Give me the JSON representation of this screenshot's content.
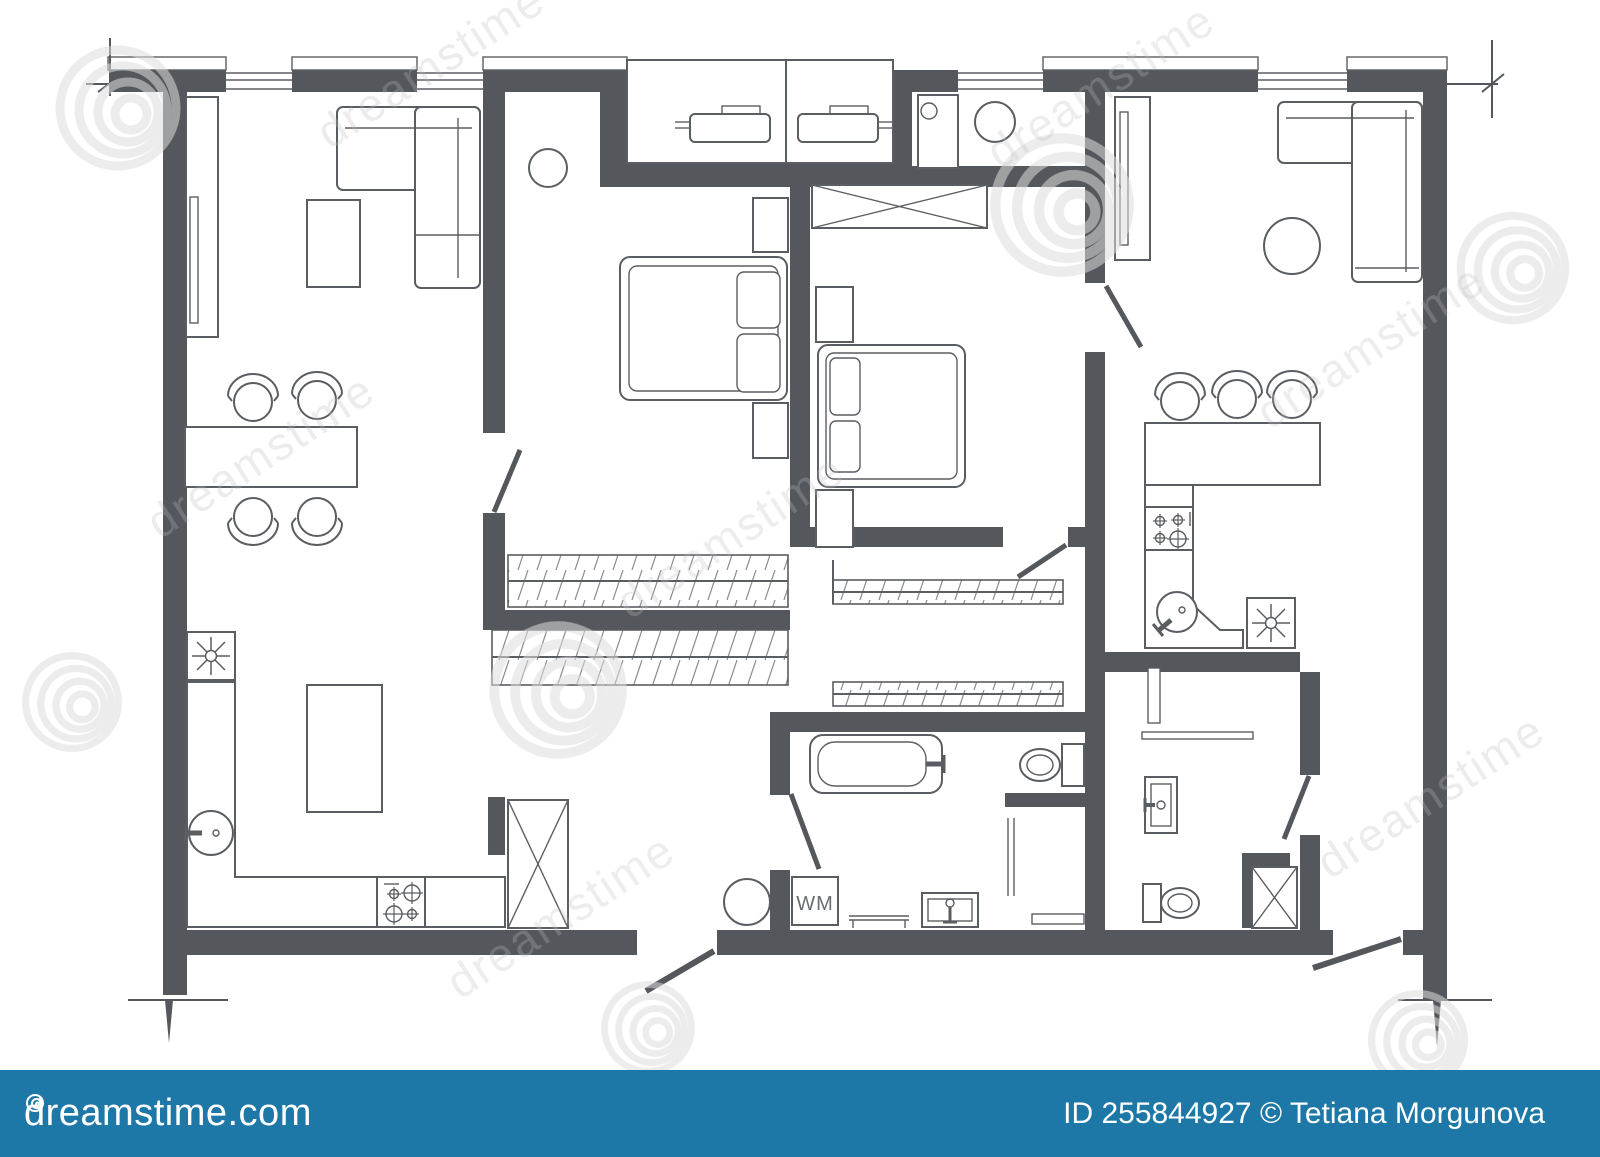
{
  "plan": {
    "wall_color": "#54575b",
    "line_color": "#5a5d61",
    "labels": {
      "washing_machine": "WM"
    },
    "fixtures": [
      "corner-sofa",
      "coffee-table",
      "bookshelf",
      "dining-table",
      "chair",
      "kitchen-sink",
      "gas-stove",
      "kitchen-island",
      "refrigerator-crossbox",
      "double-bed",
      "pillows",
      "nightstand",
      "ceiling-lamp",
      "wardrobe-rail",
      "crossed-wardrobe",
      "balcony-ac-unit",
      "boiler",
      "extractor-fan",
      "bathtub",
      "toilet",
      "washing-machine",
      "shower-glass",
      "shower-tray",
      "vanity-sink",
      "bar-counter",
      "bar-stool",
      "round-table",
      "walk-in-closet"
    ]
  },
  "watermark": {
    "text": "dreamstime",
    "spiral_color": "#dcdcdc",
    "ghost_text_color": "#bdbdbd"
  },
  "footer": {
    "logo": "dreamstime.com",
    "credit": "ID 255844927 © Tetiana Morgunova",
    "background": "#1d78a8",
    "text_color": "#ffffff"
  }
}
